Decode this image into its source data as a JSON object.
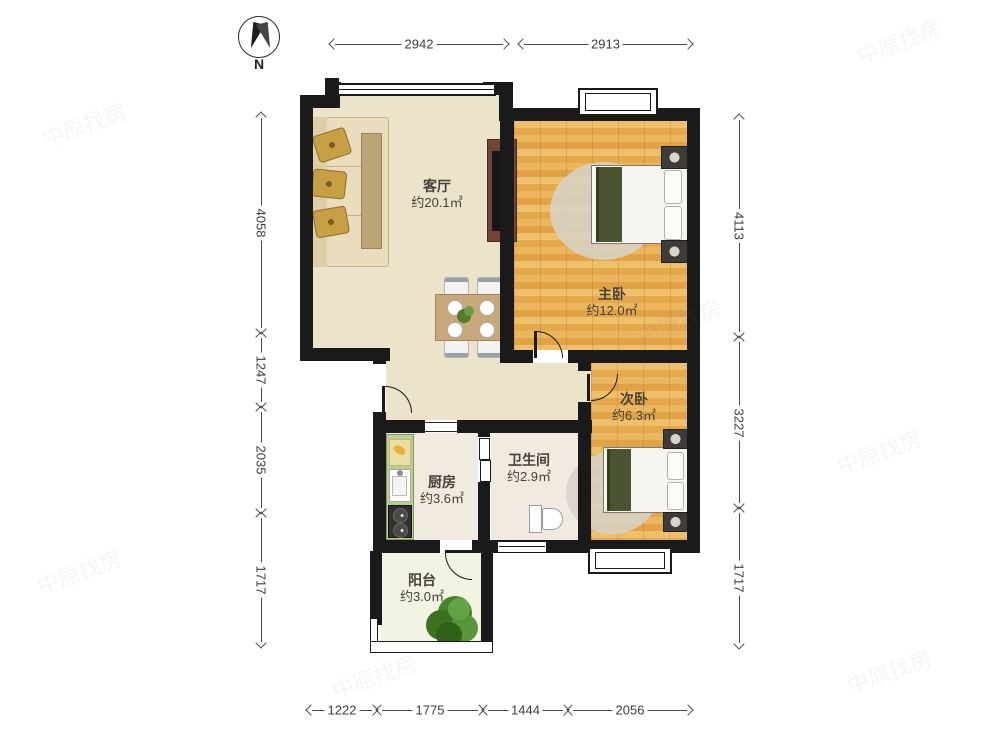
{
  "compass": {
    "label": "N"
  },
  "rooms": [
    {
      "name": "客厅",
      "area": "约20.1㎡"
    },
    {
      "name": "主卧",
      "area": "约12.0㎡"
    },
    {
      "name": "次卧",
      "area": "约6.3㎡"
    },
    {
      "name": "厨房",
      "area": "约3.6㎡"
    },
    {
      "name": "卫生间",
      "area": "约2.9㎡"
    },
    {
      "name": "阳台",
      "area": "约3.0㎡"
    }
  ],
  "dimensions": {
    "top": [
      {
        "label": "2942"
      },
      {
        "label": "2913"
      }
    ],
    "left": [
      {
        "label": "4058"
      },
      {
        "label": "1247"
      },
      {
        "label": "2035"
      },
      {
        "label": "1717"
      }
    ],
    "right": [
      {
        "label": "4113"
      },
      {
        "label": "3227"
      },
      {
        "label": "1717"
      }
    ],
    "bottom": [
      {
        "label": "1222"
      },
      {
        "label": "1775"
      },
      {
        "label": "1444"
      },
      {
        "label": "2056"
      }
    ]
  },
  "watermark": {
    "text": "中原找房"
  },
  "colors": {
    "wall": "#1a1a1a",
    "wood_floor": "#e9ad55",
    "living_floor": "#ebe4ca",
    "tile_floor": "#f1eae1",
    "balcony_floor": "#f2f3e3",
    "counter_green": "#b9cf93",
    "blanket_green": "#4b5430"
  }
}
